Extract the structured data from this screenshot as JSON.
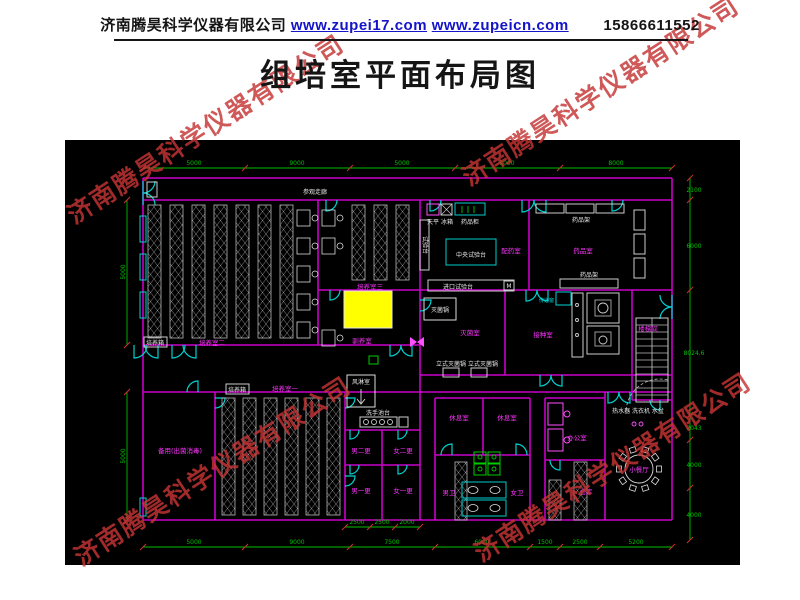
{
  "header": {
    "company": "济南腾昊科学仪器有限公司",
    "links": [
      "www.zupei17.com",
      "www.zupeicn.com"
    ],
    "phone": "15866611552"
  },
  "title": "组培室平面布局图",
  "watermark": "济南腾昊科学仪器有限公司",
  "plan": {
    "corridor": "参观走廊",
    "rooms": {
      "culture2": "培养室二",
      "culture3": "培养室三",
      "acclimation": "驯养室",
      "culture1": "培养室一",
      "spare": "备用(出菌消毒)",
      "dispensing": "配药室",
      "medicine": "药品室",
      "sterilization": "灭菌室",
      "inoculation": "接种室",
      "stairwell": "楼梯间",
      "rest1": "休息室",
      "rest2": "休息室",
      "office": "办公室",
      "storage": "仓库",
      "toilet_m": "男卫",
      "toilet_f": "女卫",
      "change_m2": "男二更",
      "change_f2": "女二更",
      "change_m1": "男一更",
      "change_f1": "女一更",
      "dining": "小餐厅"
    },
    "equipment": {
      "incubator1": "培养箱",
      "incubator2": "培养箱",
      "air_shower": "风淋室",
      "wash_basin": "洗手池台",
      "central_bench": "中央试验台",
      "balance": "天平",
      "fridge": "冰箱",
      "medicine_cabinet": "药品柜",
      "side_bench": "试验台",
      "import_bench": "进口试验台",
      "shelf_top": "药品架",
      "shelf_bottom": "药品架",
      "sterilizer": "灭菌锅",
      "vertical_sterilizers": "立式灭菌锅 立式灭菌锅",
      "transfer_window": "传递窗",
      "utility_row": "热水器 洗衣机 水盆",
      "door_tag": "M"
    },
    "dims": {
      "top": [
        "5000",
        "9000",
        "5000",
        "8000",
        "8000"
      ],
      "right": [
        "2100",
        "6000",
        "8024.6",
        "2043",
        "4000",
        "4000"
      ],
      "left": [
        "5000",
        "5000"
      ],
      "bottom": [
        "5000",
        "9000",
        "7500",
        "6000",
        "1500",
        "2500",
        "5200"
      ],
      "bottom_inner": [
        "2500",
        "2500",
        "2000"
      ]
    },
    "colors": {
      "canvas": "#000000",
      "wall": "#c800c8",
      "door": "#00d2d2",
      "dim": "#00c000",
      "tick": "#d03030",
      "room_label": "#ff35ff",
      "equipment": "#e8e8e8",
      "highlight": "#ffff00",
      "fixture": "#00cc00",
      "watermark": "#c53434",
      "link": "#1414c8"
    }
  }
}
